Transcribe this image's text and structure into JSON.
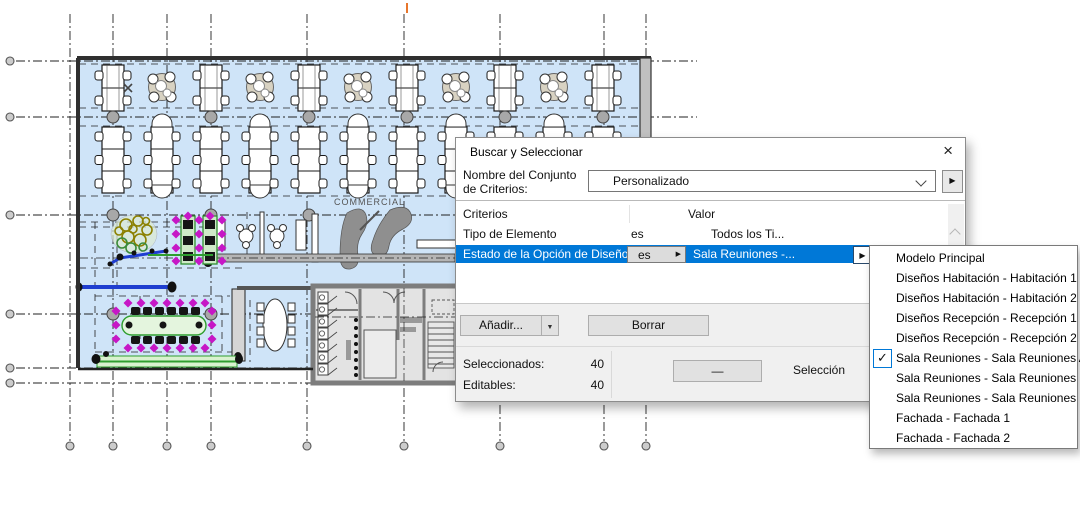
{
  "plan": {
    "commercial_label": "COMMERCIAL"
  },
  "dialog": {
    "title": "Buscar y Seleccionar",
    "close_glyph": "×",
    "criteria_set": {
      "label_line1": "Nombre del Conjunto",
      "label_line2": "de Criterios:",
      "value": "Personalizado"
    },
    "icons": {
      "right_triangle": "▶",
      "down_triangle": "▼"
    },
    "table": {
      "col_criterios": "Criterios",
      "col_valor": "Valor",
      "rows": [
        {
          "criterio": "Tipo de Elemento",
          "operador": "es",
          "valor": "Todos los Ti..."
        },
        {
          "criterio": "Estado de la Opción de Diseño",
          "operador": "es",
          "valor": "Sala Reuniones -..."
        }
      ]
    },
    "buttons": {
      "add": "Añadir...",
      "delete": "Borrar",
      "minus": "—"
    },
    "stats": {
      "selected_label": "Seleccionados:",
      "selected_value": "40",
      "editable_label": "Editables:",
      "editable_value": "40",
      "selection_label": "Selección"
    }
  },
  "menu": {
    "items": [
      {
        "label": "Modelo Principal",
        "checked": false
      },
      {
        "label": "Diseños Habitación - Habitación 1",
        "checked": false
      },
      {
        "label": "Diseños Habitación - Habitación 2",
        "checked": false
      },
      {
        "label": "Diseños Recepción - Recepción 1",
        "checked": false
      },
      {
        "label": "Diseños Recepción - Recepción 2",
        "checked": false
      },
      {
        "label": "Sala Reuniones - Sala Reuniones A",
        "checked": true
      },
      {
        "label": "Sala Reuniones - Sala Reuniones B",
        "checked": false
      },
      {
        "label": "Sala Reuniones - Sala Reuniones C",
        "checked": false
      },
      {
        "label": "Fachada - Fachada 1",
        "checked": false
      },
      {
        "label": "Fachada - Fachada 2",
        "checked": false
      }
    ],
    "check_glyph": "✓"
  },
  "colors": {
    "selection_blue": "#0078d7",
    "floor_fill": "#cfe4f8",
    "magenta_chairs": "#c617c6",
    "green_table": "#2f8f2f",
    "blue_selected_line": "#1f3ed0"
  }
}
